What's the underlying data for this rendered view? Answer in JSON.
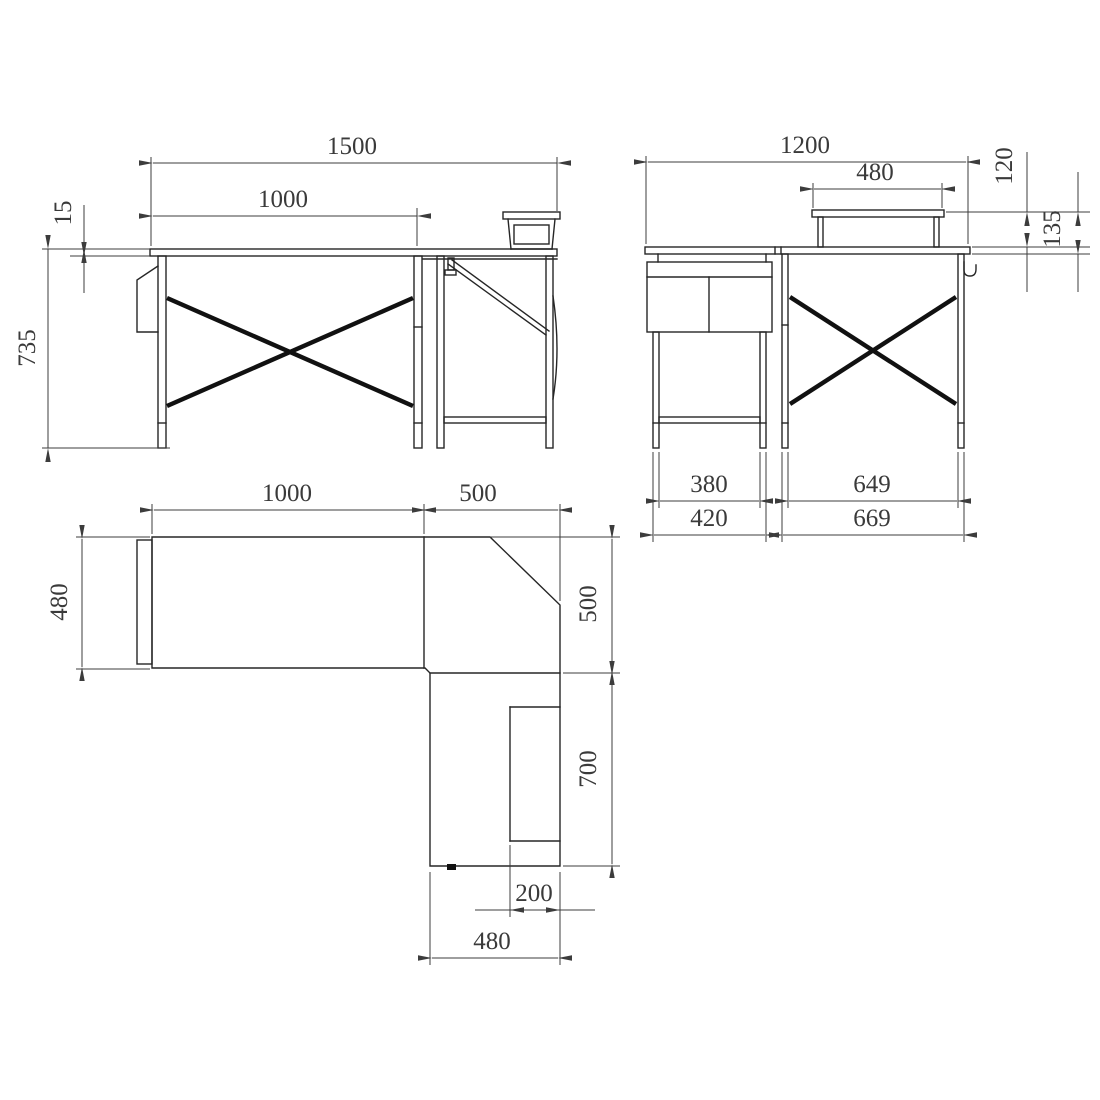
{
  "title": "L-shaped desk dimensional drawing (three orthographic views)",
  "colors": {
    "background": "#ffffff",
    "line": "#262626",
    "dimension": "#3c3c3c"
  },
  "views": {
    "front": {
      "dims": {
        "total_width": "1500",
        "main_width": "1000",
        "top_thickness": "15",
        "height": "735"
      }
    },
    "side": {
      "dims": {
        "total_depth": "1200",
        "shelf_width": "480",
        "riser_height": "120",
        "shelf_total_height": "135",
        "cabinet_feet_inner": "380",
        "cabinet_feet_outer": "420",
        "desk_feet_inner": "649",
        "desk_feet_outer": "669"
      }
    },
    "plan": {
      "dims": {
        "main_length": "1000",
        "corner_length": "500",
        "main_depth": "480",
        "corner_depth": "500",
        "return_length": "700",
        "shelf_depth": "200",
        "return_width": "480"
      }
    }
  }
}
